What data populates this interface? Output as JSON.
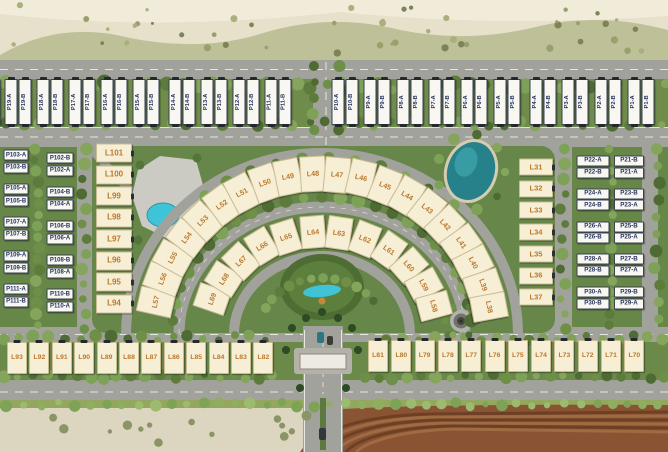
{
  "site_plan": {
    "top_row_pairs": [
      [
        "P19-A",
        "P19-B"
      ],
      [
        "P18-A",
        "P18-B"
      ],
      [
        "P17-A",
        "P17-B"
      ],
      [
        "P16-A",
        "P16-B"
      ],
      [
        "P15-A",
        "P15-B"
      ],
      [
        "P14-A",
        "P14-B"
      ],
      [
        "P13-A",
        "P13-B"
      ],
      [
        "P12-A",
        "P12-B"
      ],
      [
        "P11-A",
        "P11-B"
      ],
      [
        "P10-A",
        "P10-B"
      ],
      [
        "P9-A",
        "P9-B"
      ],
      [
        "P8-A",
        "P8-B"
      ],
      [
        "P7-A",
        "P7-B"
      ],
      [
        "P6-A",
        "P6-B"
      ],
      [
        "P5-A",
        "P5-B"
      ],
      [
        "P4-A",
        "P4-B"
      ],
      [
        "P3-A",
        "P3-B"
      ],
      [
        "P2-A",
        "P2-B"
      ],
      [
        "P1-A",
        "P1-B"
      ]
    ],
    "left_block": {
      "col1_pairs": [
        [
          "P103-A",
          "P103-B"
        ],
        [
          "P105-A",
          "P105-B"
        ],
        [
          "P107-A",
          "P107-B"
        ],
        [
          "P109-A",
          "P109-B"
        ],
        [
          "P111-A",
          "P111-B"
        ]
      ],
      "col2_pairs": [
        [
          "P102-B",
          "P102-A"
        ],
        [
          "P104-B",
          "P104-A"
        ],
        [
          "P106-B",
          "P106-A"
        ],
        [
          "P108-B",
          "P108-A"
        ],
        [
          "P110-B",
          "P110-A"
        ]
      ]
    },
    "right_block": {
      "col1_pairs": [
        [
          "P22-A",
          "P22-B"
        ],
        [
          "P24-A",
          "P24-B"
        ],
        [
          "P26-A",
          "P26-B"
        ],
        [
          "P28-A",
          "P28-B"
        ],
        [
          "P30-A",
          "P30-B"
        ]
      ],
      "col2_pairs": [
        [
          "P21-B",
          "P21-A"
        ],
        [
          "P23-B",
          "P23-A"
        ],
        [
          "P25-B",
          "P25-A"
        ],
        [
          "P27-B",
          "P27-A"
        ],
        [
          "P29-B",
          "P29-A"
        ]
      ]
    },
    "l_column_left": [
      "L101",
      "L100",
      "L99",
      "L98",
      "L97",
      "L96",
      "L95",
      "L94"
    ],
    "l_column_right": [
      "L31",
      "L32",
      "L33",
      "L34",
      "L35",
      "L36",
      "L37"
    ],
    "outer_arc": [
      "L57",
      "L56",
      "L55",
      "L54",
      "L53",
      "L52",
      "L51",
      "L50",
      "L49",
      "L48",
      "L47",
      "L46",
      "L45",
      "L44",
      "L43",
      "L42",
      "L41",
      "L40",
      "L39",
      "L38"
    ],
    "inner_arc": [
      "L69",
      "L68",
      "L67",
      "L66",
      "L65",
      "L64",
      "L63",
      "L62",
      "L61",
      "L60",
      "L59",
      "L58"
    ],
    "bottom_row_left": [
      "L93",
      "L92",
      "L91",
      "L90",
      "L89",
      "L88",
      "L87",
      "L86",
      "L85",
      "L84",
      "L83",
      "L82"
    ],
    "bottom_row_right": [
      "L81",
      "L80",
      "L79",
      "L78",
      "L77",
      "L76",
      "L75",
      "L74",
      "L73",
      "L72",
      "L71",
      "L70"
    ]
  },
  "colors": {
    "road": "#a2a29c",
    "grass": "#66864a",
    "grass_dark": "#4e6d33",
    "desert_sand": "#e7e0cb",
    "plot_white": "#f8f7f2",
    "plot_cream": "#f6eed5",
    "p_label_text": "#25335e",
    "l_label_text": "#bd792c",
    "lake": "#27818a",
    "pool": "#3fc3d6",
    "field": "#8a5434"
  }
}
